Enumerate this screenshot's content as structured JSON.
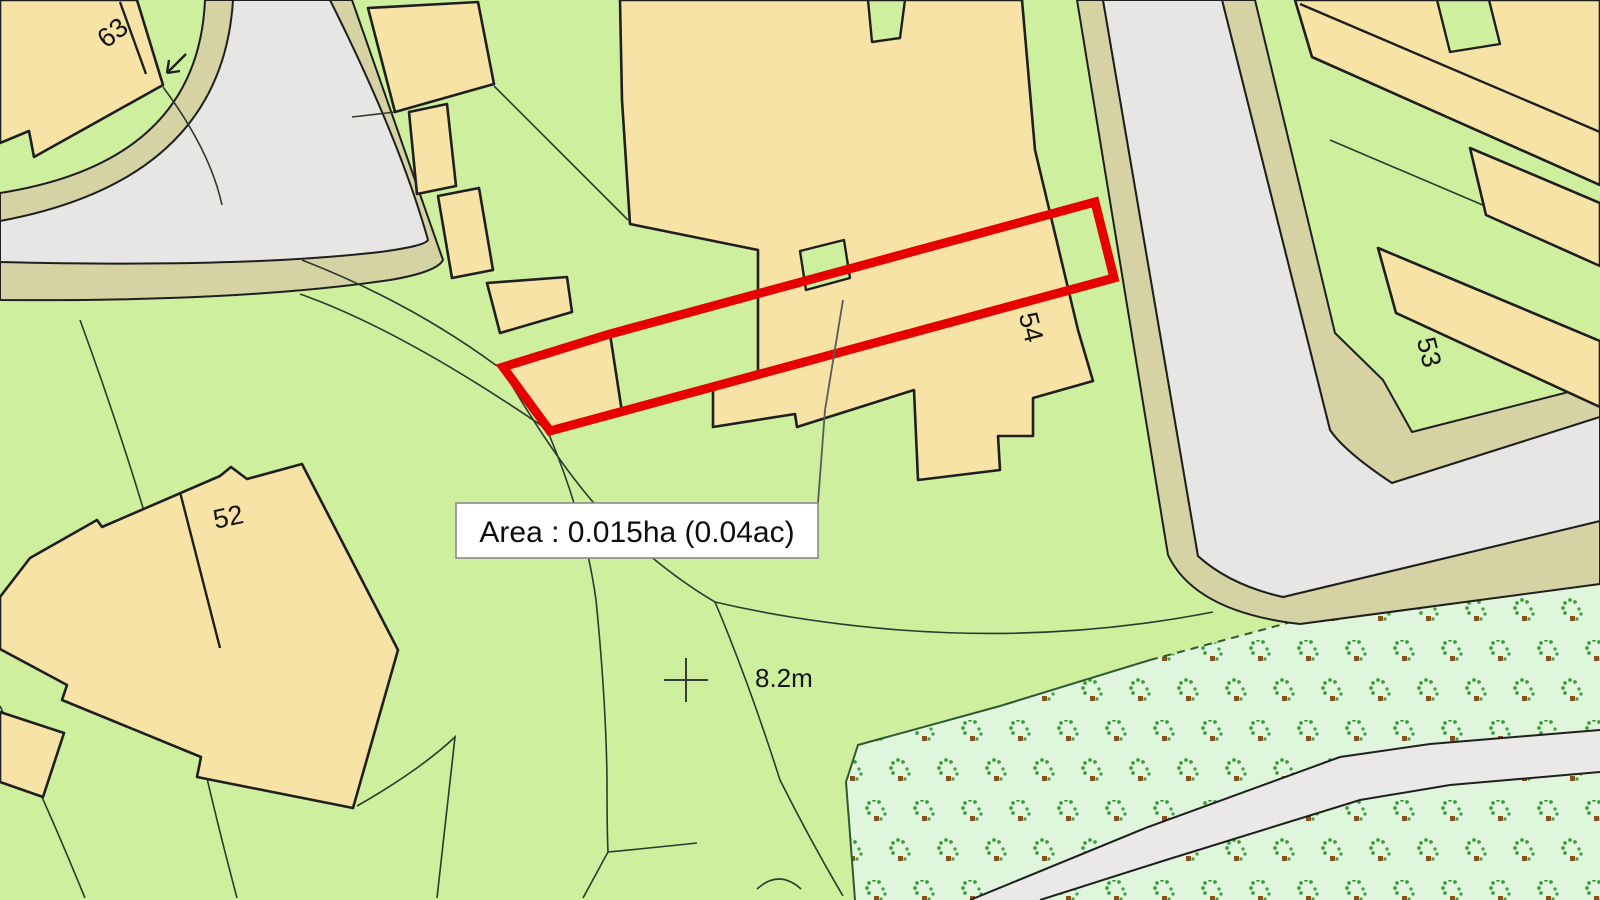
{
  "plot": {
    "area_label": "Area : 0.015ha (0.04ac)"
  },
  "spot_height": "8.2m",
  "house_numbers": {
    "h63": "63",
    "h52": "52",
    "h54": "54",
    "h53": "53"
  },
  "colors": {
    "parcel_green": "#cdef9e",
    "building_tan": "#f8e3a6",
    "road_gray": "#e7e6e4",
    "verge_khaki": "#d5d2a4",
    "orchard_mint": "#dff6dd",
    "path_gray": "#eae9e7",
    "outline_black": "#1f1f1f",
    "boundary_green": "#2f5a2f",
    "plot_red": "#e60000"
  }
}
